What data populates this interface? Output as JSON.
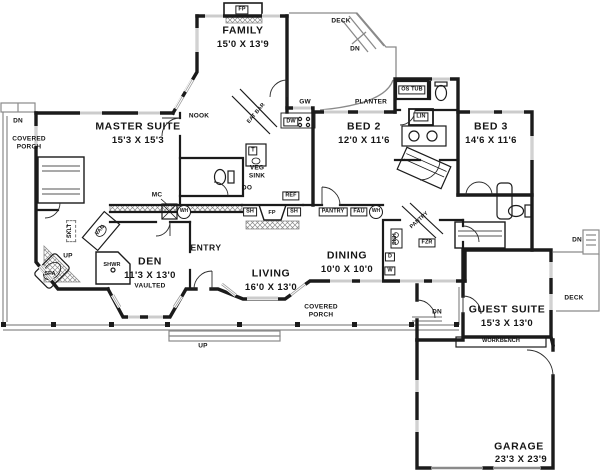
{
  "rooms": {
    "family": {
      "name": "FAMILY",
      "dims": "15'0 X 13'9"
    },
    "master_suite": {
      "name": "MASTER SUITE",
      "dims": "15'3 X 15'3"
    },
    "nook": {
      "name": "NOOK"
    },
    "bed2": {
      "name": "BED 2",
      "dims": "12'0 X 11'6"
    },
    "bed3": {
      "name": "BED 3",
      "dims": "14'6 X 11'6"
    },
    "den": {
      "name": "DEN",
      "dims": "11'3 X 13'0",
      "note": "VAULTED"
    },
    "entry": {
      "name": "ENTRY"
    },
    "living": {
      "name": "LIVING",
      "dims": "16'0 X 13'0"
    },
    "dining": {
      "name": "DINING",
      "dims": "10'0 X 10'0"
    },
    "guest_suite": {
      "name": "GUEST SUITE",
      "dims": "15'3 X 13'0"
    },
    "garage": {
      "name": "GARAGE",
      "dims": "23'3 X 23'9"
    }
  },
  "outdoor": {
    "deck_top": "DECK",
    "deck_right": "DECK",
    "planter": "PLANTER",
    "covered_porch_left": {
      "line1": "COVERED",
      "line2": "PORCH"
    },
    "covered_porch_bottom": {
      "line1": "COVERED",
      "line2": "PORCH"
    }
  },
  "fixtures": {
    "fireplace_family": "FP",
    "fireplace_living": "FP",
    "garden_window": "GW",
    "eat_bar": "EAT BAR",
    "dishwasher": "DW",
    "oversized_tub": "OS TUB",
    "linen": "LIN",
    "compactor": "T",
    "veg_sink_line1": "VEG",
    "veg_sink_line2": "SINK",
    "double_oven": "DO",
    "refrigerator": "REF",
    "shelf_left": "SH",
    "shelf_right": "SH",
    "pantry_hall": "PANTRY",
    "fau": "FAU",
    "water_heater_hall": "WH",
    "water_heater_master": "WH",
    "pantry_corner": "PANTRY",
    "freezer": "FZR",
    "utility_sink": "SNK",
    "dryer": "D",
    "washer": "W",
    "medicine_cabinet": "MC",
    "skylight": "SKLT",
    "vanity": "VAN",
    "shower": "SHWR",
    "spa": "SPA",
    "workbench": "WORKBENCH"
  },
  "stairs": {
    "deck_top_dn": "DN",
    "porch_left_dn": "DN",
    "porch_bottom_up": "UP",
    "master_bath_up": "UP",
    "guest_porch_dn": "DN",
    "deck_right_dn": "DN"
  },
  "colors": {
    "walls": "#1b1b1b",
    "thin_lines": "#8a8a8a",
    "text": "#151515",
    "background": "#ffffff"
  }
}
